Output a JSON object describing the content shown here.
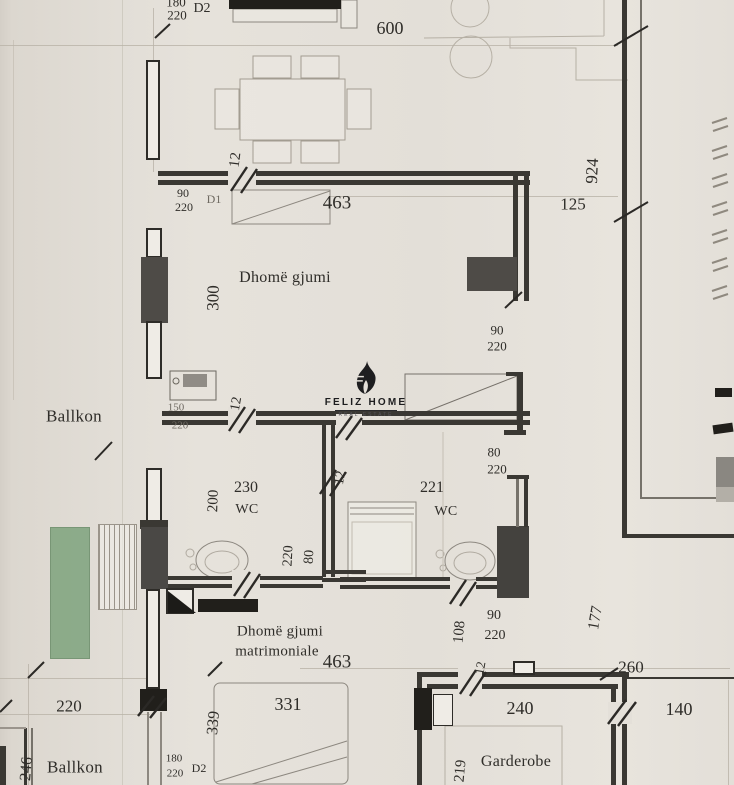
{
  "watermark": {
    "name": "FELIZ HOME",
    "tagline": "REAL ESTATE"
  },
  "rooms": [
    "Dhomë gjumi",
    "Ballkon",
    "WC",
    "WC",
    "Dhomë gjumi matrimoniale",
    "Ballkon",
    "Garderobe"
  ],
  "doors": [
    {
      "tag": "D1",
      "size": "90/220"
    },
    {
      "tag": "D2",
      "size": "180/220"
    }
  ],
  "labels": [
    {
      "t": "600",
      "x": 390,
      "y": 28,
      "s": 18,
      "n": "dim-600"
    },
    {
      "t": "180",
      "x": 176,
      "y": 2,
      "s": 13,
      "n": "dim-door-d2-width"
    },
    {
      "t": "220",
      "x": 177,
      "y": 15,
      "s": 13,
      "n": "dim-door-d2-height"
    },
    {
      "t": "D2",
      "x": 202,
      "y": 9,
      "s": 14,
      "n": "door-d2-tag"
    },
    {
      "t": "12",
      "x": 236,
      "y": 160,
      "s": 15,
      "r": -83,
      "n": "dim-12-top-wall"
    },
    {
      "t": "90",
      "x": 183,
      "y": 193,
      "s": 12,
      "n": "dim-door-d1-width"
    },
    {
      "t": "220",
      "x": 184,
      "y": 207,
      "s": 12,
      "n": "dim-door-d1-height"
    },
    {
      "t": "D1",
      "x": 214,
      "y": 199,
      "s": 12,
      "c": "faint",
      "n": "door-d1-tag"
    },
    {
      "t": "463",
      "x": 337,
      "y": 203,
      "s": 19,
      "n": "dim-463-top"
    },
    {
      "t": "924",
      "x": 592,
      "y": 171,
      "s": 17,
      "r": -87,
      "n": "dim-924"
    },
    {
      "t": "125",
      "x": 573,
      "y": 204,
      "s": 17,
      "n": "dim-125"
    },
    {
      "t": "Dhomë gjumi",
      "x": 285,
      "y": 278,
      "s": 16,
      "c": "room",
      "n": "room-label-dhome-gjumi"
    },
    {
      "t": "300",
      "x": 213,
      "y": 298,
      "s": 17,
      "r": -89,
      "n": "dim-300"
    },
    {
      "t": "90",
      "x": 497,
      "y": 330,
      "s": 13,
      "n": "dim-90-right-door"
    },
    {
      "t": "220",
      "x": 497,
      "y": 346,
      "s": 13,
      "n": "dim-220-right-door"
    },
    {
      "t": "Ballkon",
      "x": 74,
      "y": 416,
      "s": 17,
      "c": "room",
      "n": "room-label-ballkon"
    },
    {
      "t": "150",
      "x": 176,
      "y": 408,
      "s": 11,
      "c": "faint",
      "n": "dim-150-balcony-door"
    },
    {
      "t": "220",
      "x": 180,
      "y": 426,
      "s": 11,
      "c": "faint",
      "n": "dim-220-balcony-door"
    },
    {
      "t": "12",
      "x": 237,
      "y": 404,
      "s": 14,
      "r": -80,
      "n": "dim-12-balcony-wall"
    },
    {
      "t": "80",
      "x": 494,
      "y": 452,
      "s": 13,
      "n": "dim-80-right-door"
    },
    {
      "t": "220",
      "x": 497,
      "y": 469,
      "s": 13,
      "n": "dim-220-right-door-2"
    },
    {
      "t": "230",
      "x": 246,
      "y": 488,
      "s": 16,
      "n": "dim-230"
    },
    {
      "t": "200",
      "x": 214,
      "y": 501,
      "s": 15,
      "r": -88,
      "n": "dim-200"
    },
    {
      "t": "WC",
      "x": 247,
      "y": 510,
      "s": 14,
      "c": "room",
      "n": "room-label-wc-left"
    },
    {
      "t": "221",
      "x": 432,
      "y": 488,
      "s": 16,
      "n": "dim-221"
    },
    {
      "t": "WC",
      "x": 446,
      "y": 512,
      "s": 14,
      "c": "room",
      "n": "room-label-wc-right"
    },
    {
      "t": "12",
      "x": 341,
      "y": 478,
      "s": 14,
      "r": -80,
      "n": "dim-12-mid-wall"
    },
    {
      "t": "220",
      "x": 289,
      "y": 556,
      "s": 14,
      "r": -87,
      "n": "dim-220-wc-door"
    },
    {
      "t": "80",
      "x": 310,
      "y": 557,
      "s": 14,
      "r": -87,
      "n": "dim-80-wc-door"
    },
    {
      "t": "90",
      "x": 494,
      "y": 616,
      "s": 14,
      "n": "dim-90-bottom-door"
    },
    {
      "t": "220",
      "x": 495,
      "y": 636,
      "s": 14,
      "n": "dim-220-bottom-door"
    },
    {
      "t": "108",
      "x": 460,
      "y": 632,
      "s": 15,
      "r": -85,
      "n": "dim-108"
    },
    {
      "t": "177",
      "x": 596,
      "y": 618,
      "s": 16,
      "r": -80,
      "n": "dim-177"
    },
    {
      "t": "Dhomë gjumi",
      "x": 280,
      "y": 632,
      "s": 15,
      "c": "room",
      "n": "room-label-matrimoniale-line1"
    },
    {
      "t": "matrimoniale",
      "x": 277,
      "y": 652,
      "s": 15,
      "c": "room",
      "n": "room-label-matrimoniale-line2"
    },
    {
      "t": "463",
      "x": 337,
      "y": 662,
      "s": 19,
      "n": "dim-463-bottom"
    },
    {
      "t": "331",
      "x": 288,
      "y": 704,
      "s": 18,
      "n": "dim-331"
    },
    {
      "t": "339",
      "x": 214,
      "y": 723,
      "s": 16,
      "r": -85,
      "n": "dim-339"
    },
    {
      "t": "220",
      "x": 69,
      "y": 706,
      "s": 17,
      "n": "dim-220-bottom-left"
    },
    {
      "t": "246",
      "x": 27,
      "y": 769,
      "s": 16,
      "r": -85,
      "n": "dim-246"
    },
    {
      "t": "Ballkon",
      "x": 75,
      "y": 767,
      "s": 17,
      "c": "room",
      "n": "room-label-ballkon-bottom"
    },
    {
      "t": "180",
      "x": 174,
      "y": 759,
      "s": 11,
      "n": "dim-180-d2-bottom"
    },
    {
      "t": "220",
      "x": 175,
      "y": 774,
      "s": 11,
      "n": "dim-220-d2-bottom"
    },
    {
      "t": "D2",
      "x": 199,
      "y": 768,
      "s": 12,
      "n": "door-d2-tag-bottom"
    },
    {
      "t": "260",
      "x": 631,
      "y": 667,
      "s": 17,
      "n": "dim-260"
    },
    {
      "t": "240",
      "x": 520,
      "y": 708,
      "s": 18,
      "n": "dim-240"
    },
    {
      "t": "140",
      "x": 679,
      "y": 709,
      "s": 18,
      "n": "dim-140"
    },
    {
      "t": "Garderobe",
      "x": 516,
      "y": 762,
      "s": 16,
      "c": "room",
      "n": "room-label-garderobe"
    },
    {
      "t": "219",
      "x": 461,
      "y": 771,
      "s": 15,
      "r": -85,
      "n": "dim-219"
    },
    {
      "t": "12",
      "x": 480,
      "y": 668,
      "s": 13,
      "r": -80,
      "n": "dim-12-garderobe"
    }
  ]
}
